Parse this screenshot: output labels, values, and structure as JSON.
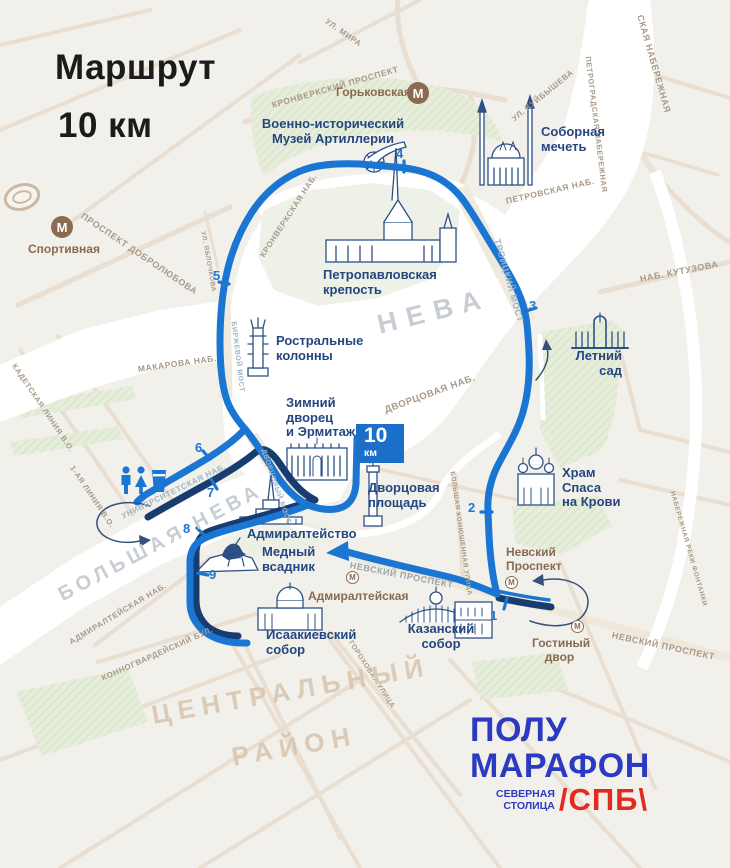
{
  "title": {
    "line1": "Маршрут",
    "line2": "10 км"
  },
  "finish_badge": {
    "value": "10",
    "unit": "км"
  },
  "logo": {
    "word1": "ПОЛУ",
    "word2": "МАРАФОН",
    "sub_line1": "СЕВЕРНАЯ",
    "sub_line2": "СТОЛИЦА",
    "tag": "/СПБ\\"
  },
  "colors": {
    "route_blue": "#1b76d3",
    "route_navy": "#173c6f",
    "landmark_text": "#24477f",
    "metro_brown": "#8a6a50",
    "badge_blue": "#1b6fc8",
    "logo_blue": "#2b3ac0",
    "logo_red": "#e42a1e"
  },
  "area_labels": [
    {
      "id": "neva",
      "text": "НЕВА",
      "x": 378,
      "y": 310,
      "rot": -14,
      "size": 27,
      "spacing": 10,
      "cls": "waterlbl"
    },
    {
      "id": "bolshaya-neva",
      "text": "БОЛЬШАЯ НЕВА",
      "x": 60,
      "y": 585,
      "rot": -28,
      "size": 20,
      "spacing": 5,
      "cls": "waterlbl"
    },
    {
      "id": "district-line1",
      "text": "ЦЕНТРАЛЬНЫЙ",
      "x": 152,
      "y": 700,
      "rot": -10,
      "size": 26,
      "spacing": 7,
      "cls": "district"
    },
    {
      "id": "district-line2",
      "text": "РАЙОН",
      "x": 232,
      "y": 742,
      "rot": -10,
      "size": 26,
      "spacing": 7,
      "cls": "district"
    }
  ],
  "street_labels": [
    {
      "text": "УЛ. МИРА",
      "x": 326,
      "y": 16,
      "rot": 35,
      "size": 8
    },
    {
      "text": "КРОНВЕРКСКИЙ ПРОСПЕКТ",
      "x": 272,
      "y": 100,
      "rot": -16,
      "size": 8.5
    },
    {
      "text": "СКАЯ НАБЕРЕЖНАЯ",
      "x": 640,
      "y": 10,
      "rot": 74,
      "size": 9
    },
    {
      "text": "ПЕТРОГРАДСКАЯ НАБЕРЕЖНАЯ",
      "x": 588,
      "y": 52,
      "rot": 83,
      "size": 7.5
    },
    {
      "text": "УЛ. КУЙБЫШЕВА",
      "x": 513,
      "y": 115,
      "rot": -39,
      "size": 8
    },
    {
      "text": "ПЕТРОВСКАЯ НАБ.",
      "x": 506,
      "y": 196,
      "rot": -13,
      "size": 8.5
    },
    {
      "text": "ПРОСПЕКТ ДОБРОЛЮБОВА",
      "x": 82,
      "y": 210,
      "rot": 34,
      "size": 9
    },
    {
      "text": "УЛ. ЯБЛОЧКОВА",
      "x": 203,
      "y": 228,
      "rot": 80,
      "size": 6.5
    },
    {
      "text": "КРОНВЕРКСКАЯ НАБ.",
      "x": 262,
      "y": 252,
      "rot": -57,
      "size": 8
    },
    {
      "text": "ТРОИЦКИЙ МОСТ",
      "x": 497,
      "y": 234,
      "rot": 74,
      "size": 9,
      "cls": "bridge"
    },
    {
      "text": "НАБ. КУТУЗОВА",
      "x": 640,
      "y": 274,
      "rot": -11,
      "size": 9
    },
    {
      "text": "МАКАРОВА НАБ.",
      "x": 138,
      "y": 364,
      "rot": -8,
      "size": 8.5
    },
    {
      "text": "БИРЖЕВОЙ МОСТ",
      "x": 233,
      "y": 318,
      "rot": 83,
      "size": 7,
      "cls": "bridge"
    },
    {
      "text": "КАДЕТСКАЯ ЛИНИЯ В.О.",
      "x": 14,
      "y": 360,
      "rot": 56,
      "size": 7.5
    },
    {
      "text": "1-АЯ ЛИНИЯ В.О.",
      "x": 72,
      "y": 462,
      "rot": 56,
      "size": 7.5
    },
    {
      "text": "УНИВЕРСИТЕТСКАЯ НАБ.",
      "x": 122,
      "y": 512,
      "rot": -26,
      "size": 8,
      "cls": "bridge"
    },
    {
      "text": "ДВОРЦОВАЯ НАБ.",
      "x": 385,
      "y": 405,
      "rot": -20,
      "size": 9.5
    },
    {
      "text": "ДВОРЦОВЫЙ МОСТ",
      "x": 263,
      "y": 446,
      "rot": 71,
      "size": 7,
      "cls": "bridge"
    },
    {
      "text": "БОЛЬШАЯ КОНЮШЕННАЯ УЛИЦА",
      "x": 452,
      "y": 468,
      "rot": 82,
      "size": 6.5
    },
    {
      "text": "НЕВСКИЙ ПРОСПЕКТ",
      "x": 350,
      "y": 560,
      "rot": 11,
      "size": 9,
      "cls": "gray"
    },
    {
      "text": "ГОРОХОВАЯ УЛИЦА",
      "x": 350,
      "y": 638,
      "rot": 57,
      "size": 7
    },
    {
      "text": "НЕВСКИЙ ПРОСПЕКТ",
      "x": 612,
      "y": 630,
      "rot": 12,
      "size": 9
    },
    {
      "text": "НАБЕРЕЖНАЯ РЕКИ ФОНТАНКИ",
      "x": 672,
      "y": 488,
      "rot": 74,
      "size": 6.5
    },
    {
      "text": "КОННОГВАРДЕЙСКИЙ БУЛ.",
      "x": 102,
      "y": 674,
      "rot": -24,
      "size": 8
    },
    {
      "text": "АДМИРАЛТЕЙСКАЯ НАБ.",
      "x": 70,
      "y": 638,
      "rot": -31,
      "size": 8
    }
  ],
  "landmark_labels": [
    {
      "id": "artillery-museum",
      "text": "Военно-исторический\nМузей Артиллерии",
      "x": 258,
      "y": 117,
      "w": 150,
      "align": "center"
    },
    {
      "id": "cathedral-mosque",
      "text": "Соборная\nмечеть",
      "x": 541,
      "y": 125,
      "w": 80,
      "align": "left"
    },
    {
      "id": "peter-paul-fortress",
      "text": "Петропавловская\nкрепость",
      "x": 323,
      "y": 268,
      "w": 115,
      "align": "left"
    },
    {
      "id": "rostral-columns",
      "text": "Ростральные\nколонны",
      "x": 276,
      "y": 334,
      "w": 95,
      "align": "left"
    },
    {
      "id": "summer-garden",
      "text": "Летний\nсад",
      "x": 558,
      "y": 349,
      "w": 64,
      "align": "right"
    },
    {
      "id": "winter-palace",
      "text": "Зимний\nдворец\nи Эрмитаж",
      "x": 286,
      "y": 396,
      "w": 85,
      "align": "left"
    },
    {
      "id": "savior-on-blood",
      "text": "Храм\nСпаса\nна Крови",
      "x": 562,
      "y": 466,
      "w": 70,
      "align": "left"
    },
    {
      "id": "palace-square",
      "text": "Дворцовая\nплощадь",
      "x": 368,
      "y": 481,
      "w": 85,
      "align": "left"
    },
    {
      "id": "admiralty",
      "text": "Адмиралтейство",
      "x": 247,
      "y": 527,
      "w": 125,
      "align": "left"
    },
    {
      "id": "bronze-horseman",
      "text": "Медный\nвсадник",
      "x": 262,
      "y": 545,
      "w": 70,
      "align": "left"
    },
    {
      "id": "st-isaacs-cathedral",
      "text": "Исаакиевский\nсобор",
      "x": 266,
      "y": 628,
      "w": 100,
      "align": "left"
    },
    {
      "id": "kazan-cathedral",
      "text": "Казанский\nсобор",
      "x": 404,
      "y": 622,
      "w": 74,
      "align": "center"
    }
  ],
  "metro_stations": [
    {
      "id": "gorkovskaya",
      "label": "Горьковская",
      "icon": {
        "x": 407,
        "y": 82,
        "big": true
      },
      "label_pos": {
        "x": 336,
        "y": 86,
        "w": 68,
        "align": "right"
      }
    },
    {
      "id": "sportivnaya",
      "label": "Спортивная",
      "icon": {
        "x": 51,
        "y": 216,
        "big": true
      },
      "label_pos": {
        "x": 28,
        "y": 243,
        "w": 70,
        "align": "left"
      }
    },
    {
      "id": "admiralteyskaya",
      "label": "Адмиралтейская",
      "icon": {
        "x": 346,
        "y": 571,
        "big": false
      },
      "label_pos": {
        "x": 308,
        "y": 590,
        "w": 95,
        "align": "left"
      }
    },
    {
      "id": "nevsky-prospekt",
      "label": "Невский\nПроспект",
      "icon": {
        "x": 505,
        "y": 576,
        "big": false
      },
      "label_pos": {
        "x": 506,
        "y": 546,
        "w": 60,
        "align": "left"
      }
    },
    {
      "id": "gostiny-dvor",
      "label": "Гостиный\nдвор",
      "icon": {
        "x": 571,
        "y": 620,
        "big": false
      },
      "label_pos": {
        "x": 532,
        "y": 637,
        "w": 55,
        "align": "center"
      }
    }
  ],
  "km_markers": [
    {
      "n": "1",
      "x": 490,
      "y": 608
    },
    {
      "n": "2",
      "x": 468,
      "y": 500
    },
    {
      "n": "3",
      "x": 529,
      "y": 298
    },
    {
      "n": "4",
      "x": 396,
      "y": 146
    },
    {
      "n": "5",
      "x": 213,
      "y": 268
    },
    {
      "n": "6",
      "x": 195,
      "y": 440
    },
    {
      "n": "7",
      "x": 207,
      "y": 485
    },
    {
      "n": "8",
      "x": 183,
      "y": 521
    },
    {
      "n": "9",
      "x": 209,
      "y": 567
    }
  ]
}
